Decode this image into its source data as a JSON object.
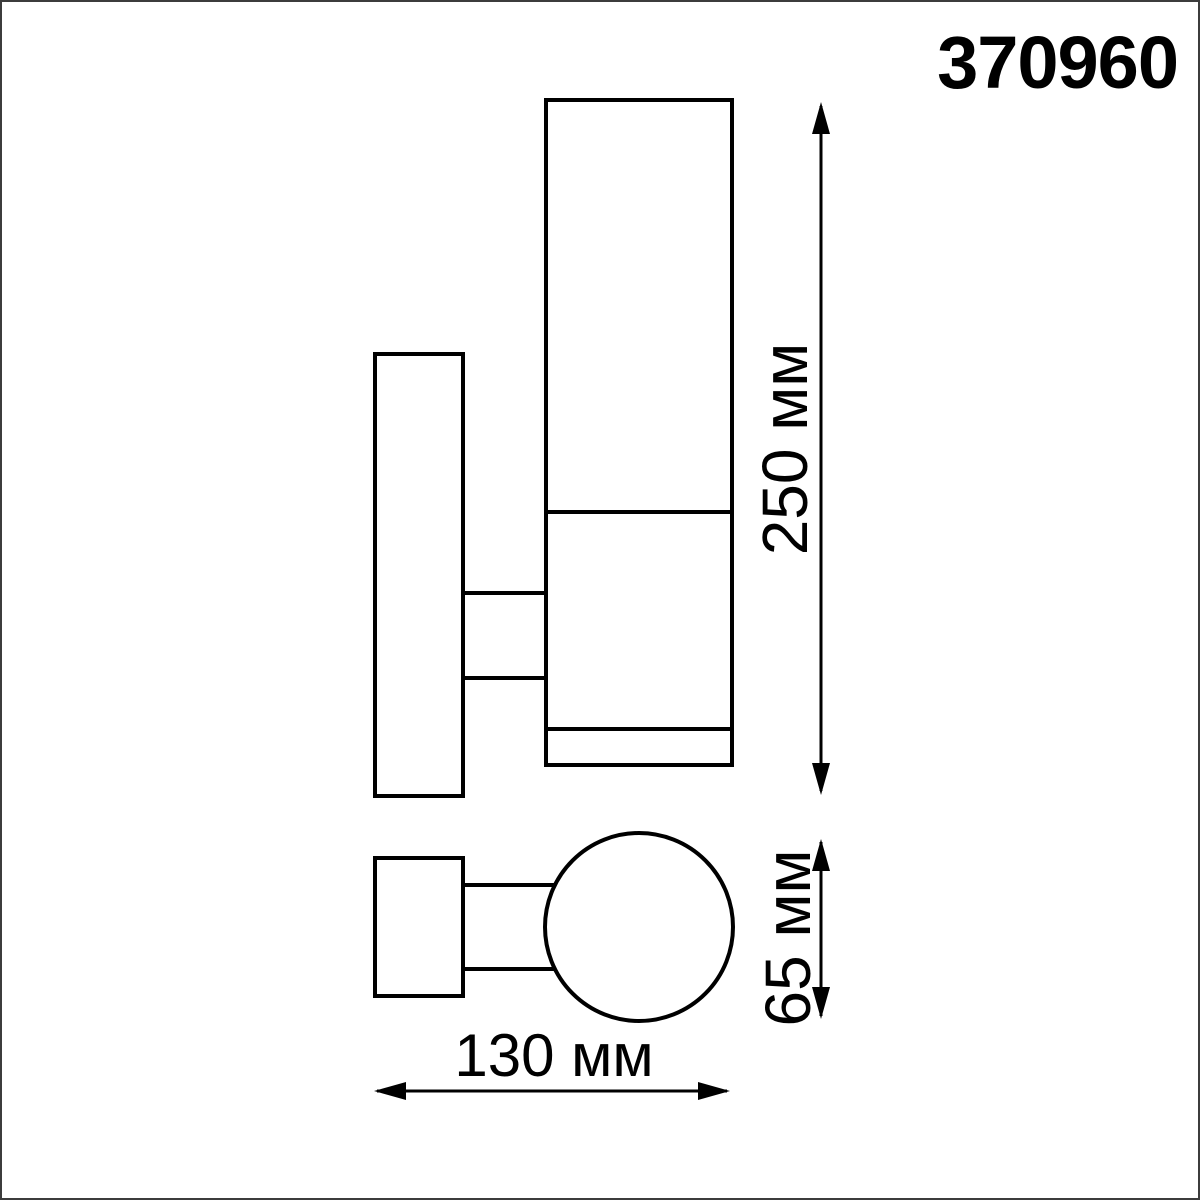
{
  "header": {
    "product_code": "370960"
  },
  "diagram": {
    "type": "technical-dimension-drawing",
    "subject": "wall-mounted cylindrical luminaire, side view and bottom view",
    "dimensions": {
      "height": {
        "value": 250,
        "unit": "мм",
        "label": "250 мм"
      },
      "body_diameter": {
        "value": 65,
        "unit": "мм",
        "label": "65 мм"
      },
      "width": {
        "value": 130,
        "unit": "мм",
        "label": "130 мм"
      }
    },
    "colors": {
      "line": "#000000",
      "background": "#ffffff",
      "frame": "#3c3c3c"
    }
  }
}
